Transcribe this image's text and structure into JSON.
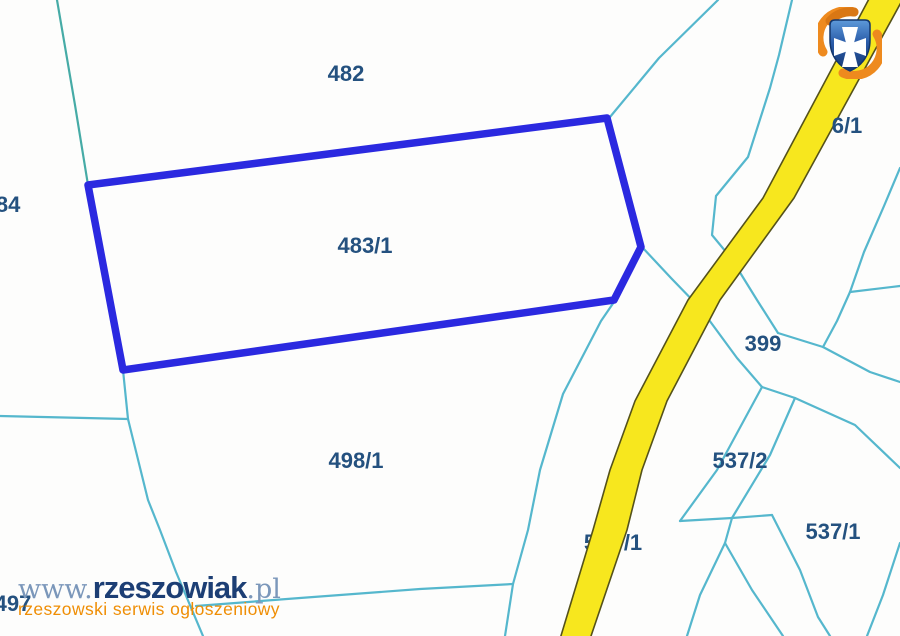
{
  "map": {
    "type": "cadastral-parcel-map",
    "background_color": "#fdfdfc",
    "parcel_line_color": "#55b7cd",
    "road_color": "#f7e71e",
    "road_border_color": "#55521a",
    "highlight": {
      "parcel": "483/1",
      "outline_color": "#2b29e0"
    },
    "labels": [
      {
        "text": "484"
      },
      {
        "text": "482"
      },
      {
        "text": "483/1"
      },
      {
        "text": "497"
      },
      {
        "text": "498/1"
      },
      {
        "text": "399"
      },
      {
        "text": "537/2"
      },
      {
        "text": "537/1"
      },
      {
        "text": "6/1"
      }
    ],
    "road_label": {
      "left_fragment": "5",
      "right_fragment": "/1"
    },
    "label_color": "#24517f"
  },
  "watermark": {
    "www": "www.",
    "name": "rzeszowiak",
    "tld": ".pl",
    "tagline": "rzeszowski serwis ogłoszeniowy",
    "name_color": "#1c3e74",
    "accent_color": "#ef8e05"
  },
  "logo": {
    "name": "rzeszow-crest-logo",
    "shield_color": "#2a5ba8",
    "cross_color": "#ffffff",
    "swirl_color": "#ee8a1e"
  }
}
